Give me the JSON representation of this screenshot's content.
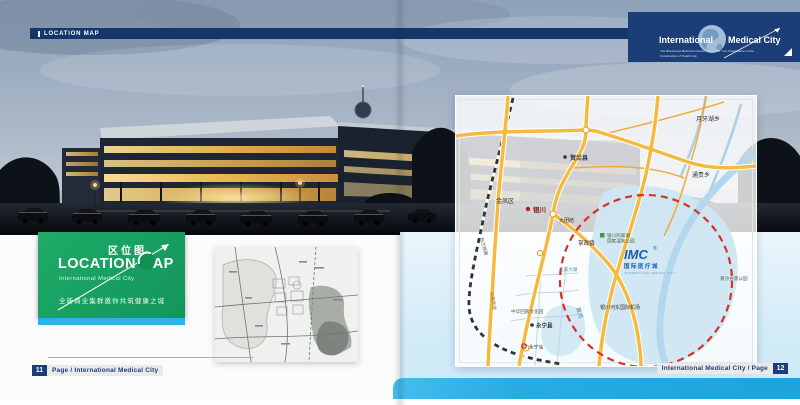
{
  "header": {
    "bar_label": "LOCATION MAP"
  },
  "brand": {
    "name_left": "International",
    "name_right": "Medical City",
    "tagline_line1": "The Brand-new Business Cluster Inviting for Your Participation in the",
    "tagline_line2": "Construction of Health City"
  },
  "title_card": {
    "title_cn": "区位图",
    "title_en": "LOCATION MAP",
    "subtitle": "International Medical City",
    "slogan_cn": "全新商业集群邀你共筑健康之城"
  },
  "map": {
    "imc_logo": {
      "abbr": "IMC",
      "reg": "®",
      "cn": "国际医疗城",
      "en": "INTERNATIONAL MEDICAL CITY"
    },
    "labels": {
      "yueyahu": "月牙湖乡",
      "helan": "贺兰县",
      "tonggui": "通贵乡",
      "jinfeng": "金凤区",
      "yinchuan": "银川",
      "datuanjie": "大团结",
      "zhangzheng": "掌政镇",
      "wetland_line1": "银川鸣翠湖",
      "wetland_line2": "国家湿地公园",
      "wangjia_lake": "王家大湖",
      "yellow_river": "黄河",
      "airport": "银川河东国际机场",
      "hui_park": "中华回族文化园",
      "yongning": "永宁县",
      "yongning_station": "永宁站",
      "jingzang_expwy": "京藏高速",
      "baolan_railway": "包兰铁路",
      "huangsha_park": "黄沙古渡公园"
    }
  },
  "footer": {
    "left_page_number": "11",
    "left_label": "Page / International Medical City",
    "right_label": "International Medical City / Page",
    "right_page_number": "12"
  },
  "colors": {
    "navy": "#1c3e78",
    "green": "#18a160",
    "cyan": "#29abe2",
    "panel_blue": "#d6ecf8",
    "road_yellow": "#f5b93f",
    "water_blue": "#cfe6f2",
    "red_dashed": "#d93025"
  }
}
